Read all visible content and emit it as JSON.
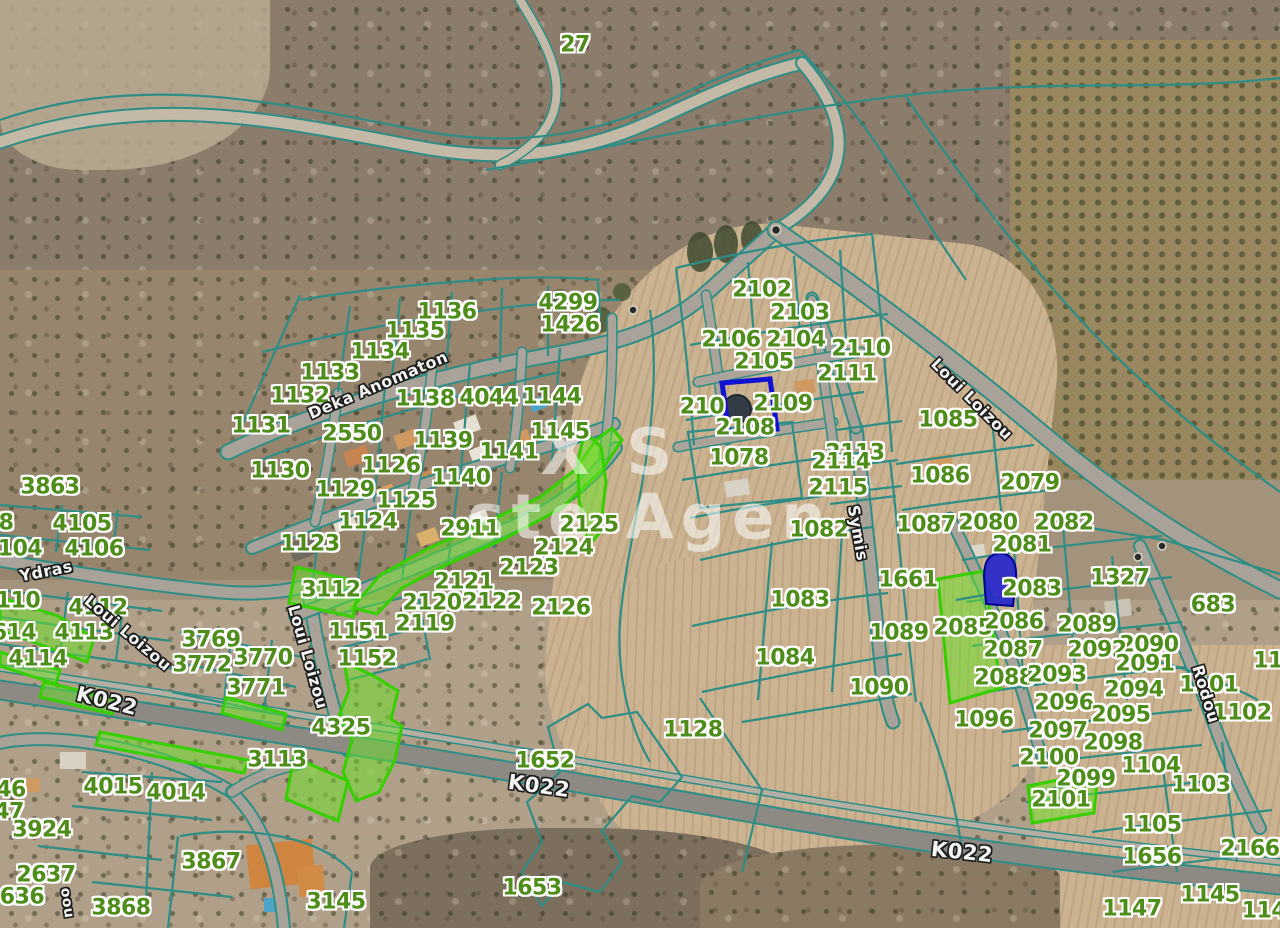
{
  "map": {
    "watermark": {
      "line1": "X S",
      "line2": "ste Agen"
    },
    "colors": {
      "parcel_number_green": "#4f8d1b",
      "boundary_teal": "#2e8e86",
      "highlight_green": "#35cf00",
      "selection_blue": "#1111d4",
      "road_label_white": "#f4f4f2"
    },
    "parcel_labels": [
      {
        "text": "27",
        "x": 575,
        "y": 45
      },
      {
        "text": "1136",
        "x": 447,
        "y": 312
      },
      {
        "text": "1135",
        "x": 415,
        "y": 331
      },
      {
        "text": "4299",
        "x": 568,
        "y": 303
      },
      {
        "text": "1426",
        "x": 570,
        "y": 325
      },
      {
        "text": "1134",
        "x": 380,
        "y": 352
      },
      {
        "text": "1133",
        "x": 330,
        "y": 373
      },
      {
        "text": "1132",
        "x": 300,
        "y": 396
      },
      {
        "text": "1131",
        "x": 261,
        "y": 426
      },
      {
        "text": "1138",
        "x": 425,
        "y": 399
      },
      {
        "text": "4044",
        "x": 489,
        "y": 398
      },
      {
        "text": "1144",
        "x": 552,
        "y": 397
      },
      {
        "text": "2550",
        "x": 352,
        "y": 434
      },
      {
        "text": "1139",
        "x": 443,
        "y": 441
      },
      {
        "text": "1145",
        "x": 560,
        "y": 432
      },
      {
        "text": "1141",
        "x": 509,
        "y": 452
      },
      {
        "text": "1130",
        "x": 280,
        "y": 471
      },
      {
        "text": "1126",
        "x": 391,
        "y": 466
      },
      {
        "text": "1140",
        "x": 461,
        "y": 478
      },
      {
        "text": "1129",
        "x": 345,
        "y": 490
      },
      {
        "text": "1125",
        "x": 406,
        "y": 501
      },
      {
        "text": "1124",
        "x": 368,
        "y": 522
      },
      {
        "text": "1123",
        "x": 310,
        "y": 544
      },
      {
        "text": "2911",
        "x": 470,
        "y": 529
      },
      {
        "text": "2125",
        "x": 589,
        "y": 525
      },
      {
        "text": "2124",
        "x": 564,
        "y": 548
      },
      {
        "text": "2123",
        "x": 529,
        "y": 568
      },
      {
        "text": "3112",
        "x": 331,
        "y": 590
      },
      {
        "text": "2121",
        "x": 464,
        "y": 582
      },
      {
        "text": "2120",
        "x": 432,
        "y": 603
      },
      {
        "text": "2122",
        "x": 492,
        "y": 602
      },
      {
        "text": "2126",
        "x": 561,
        "y": 608
      },
      {
        "text": "2119",
        "x": 425,
        "y": 624
      },
      {
        "text": "1151",
        "x": 358,
        "y": 632
      },
      {
        "text": "1152",
        "x": 367,
        "y": 659
      },
      {
        "text": "2102",
        "x": 762,
        "y": 290
      },
      {
        "text": "2103",
        "x": 800,
        "y": 313
      },
      {
        "text": "2106",
        "x": 731,
        "y": 340
      },
      {
        "text": "2104",
        "x": 796,
        "y": 340
      },
      {
        "text": "2110",
        "x": 861,
        "y": 349
      },
      {
        "text": "2105",
        "x": 764,
        "y": 362
      },
      {
        "text": "2111",
        "x": 847,
        "y": 374
      },
      {
        "text": "210",
        "x": 702,
        "y": 407
      },
      {
        "text": "2109",
        "x": 783,
        "y": 404
      },
      {
        "text": "2108",
        "x": 745,
        "y": 428
      },
      {
        "text": "1078",
        "x": 739,
        "y": 458
      },
      {
        "text": "2113",
        "x": 855,
        "y": 453
      },
      {
        "text": "1085",
        "x": 948,
        "y": 420
      },
      {
        "text": "2114",
        "x": 841,
        "y": 462
      },
      {
        "text": "1086",
        "x": 940,
        "y": 476
      },
      {
        "text": "2115",
        "x": 838,
        "y": 488
      },
      {
        "text": "2079",
        "x": 1030,
        "y": 483
      },
      {
        "text": "1082",
        "x": 819,
        "y": 530
      },
      {
        "text": "1087",
        "x": 926,
        "y": 525
      },
      {
        "text": "2080",
        "x": 988,
        "y": 523
      },
      {
        "text": "2082",
        "x": 1064,
        "y": 523
      },
      {
        "text": "2081",
        "x": 1022,
        "y": 545
      },
      {
        "text": "1661",
        "x": 908,
        "y": 580
      },
      {
        "text": "1083",
        "x": 800,
        "y": 600
      },
      {
        "text": "2083",
        "x": 1032,
        "y": 589
      },
      {
        "text": "1327",
        "x": 1120,
        "y": 578
      },
      {
        "text": "683",
        "x": 1213,
        "y": 605
      },
      {
        "text": "1089",
        "x": 899,
        "y": 633
      },
      {
        "text": "2085",
        "x": 963,
        "y": 628
      },
      {
        "text": "2086",
        "x": 1014,
        "y": 622
      },
      {
        "text": "2089",
        "x": 1087,
        "y": 625
      },
      {
        "text": "2090",
        "x": 1149,
        "y": 645
      },
      {
        "text": "1084",
        "x": 785,
        "y": 658
      },
      {
        "text": "2087",
        "x": 1013,
        "y": 650
      },
      {
        "text": "2092",
        "x": 1097,
        "y": 650
      },
      {
        "text": "2091",
        "x": 1145,
        "y": 664
      },
      {
        "text": "2088",
        "x": 1004,
        "y": 678
      },
      {
        "text": "2093",
        "x": 1057,
        "y": 675
      },
      {
        "text": "2094",
        "x": 1134,
        "y": 690
      },
      {
        "text": "1101",
        "x": 1209,
        "y": 685
      },
      {
        "text": "1090",
        "x": 879,
        "y": 688
      },
      {
        "text": "2096",
        "x": 1064,
        "y": 703
      },
      {
        "text": "2095",
        "x": 1121,
        "y": 715
      },
      {
        "text": "1102",
        "x": 1242,
        "y": 713
      },
      {
        "text": "1096",
        "x": 984,
        "y": 720
      },
      {
        "text": "2097",
        "x": 1058,
        "y": 731
      },
      {
        "text": "2098",
        "x": 1113,
        "y": 743
      },
      {
        "text": "2100",
        "x": 1049,
        "y": 758
      },
      {
        "text": "1104",
        "x": 1151,
        "y": 766
      },
      {
        "text": "2099",
        "x": 1086,
        "y": 779
      },
      {
        "text": "1103",
        "x": 1201,
        "y": 785
      },
      {
        "text": "2101",
        "x": 1061,
        "y": 800
      },
      {
        "text": "1105",
        "x": 1152,
        "y": 825
      },
      {
        "text": "1656",
        "x": 1152,
        "y": 857
      },
      {
        "text": "2166",
        "x": 1250,
        "y": 849
      },
      {
        "text": "11",
        "x": 1268,
        "y": 661
      },
      {
        "text": "1145",
        "x": 1210,
        "y": 895
      },
      {
        "text": "1147",
        "x": 1132,
        "y": 909
      },
      {
        "text": "114",
        "x": 1264,
        "y": 911
      },
      {
        "text": "1128",
        "x": 693,
        "y": 730
      },
      {
        "text": "1652",
        "x": 545,
        "y": 761
      },
      {
        "text": "1653",
        "x": 532,
        "y": 888
      },
      {
        "text": "3145",
        "x": 336,
        "y": 902
      },
      {
        "text": "3863",
        "x": 50,
        "y": 487
      },
      {
        "text": "8",
        "x": 6,
        "y": 523
      },
      {
        "text": "4105",
        "x": 82,
        "y": 524
      },
      {
        "text": "104",
        "x": 20,
        "y": 549
      },
      {
        "text": "4106",
        "x": 94,
        "y": 549
      },
      {
        "text": "110",
        "x": 18,
        "y": 601
      },
      {
        "text": "4112",
        "x": 98,
        "y": 608
      },
      {
        "text": "614",
        "x": 14,
        "y": 633
      },
      {
        "text": "4113",
        "x": 84,
        "y": 633
      },
      {
        "text": "4114",
        "x": 38,
        "y": 659
      },
      {
        "text": "3769",
        "x": 211,
        "y": 640
      },
      {
        "text": "3770",
        "x": 263,
        "y": 658
      },
      {
        "text": "3772",
        "x": 202,
        "y": 665
      },
      {
        "text": "3771",
        "x": 256,
        "y": 688
      },
      {
        "text": "4325",
        "x": 341,
        "y": 728
      },
      {
        "text": "3113",
        "x": 277,
        "y": 760
      },
      {
        "text": "4015",
        "x": 113,
        "y": 787
      },
      {
        "text": "4014",
        "x": 176,
        "y": 793
      },
      {
        "text": "46",
        "x": 11,
        "y": 790
      },
      {
        "text": "47",
        "x": 9,
        "y": 812
      },
      {
        "text": "3924",
        "x": 42,
        "y": 830
      },
      {
        "text": "2637",
        "x": 46,
        "y": 875
      },
      {
        "text": "636",
        "x": 22,
        "y": 897
      },
      {
        "text": "3867",
        "x": 211,
        "y": 862
      },
      {
        "text": "3868",
        "x": 121,
        "y": 908
      }
    ],
    "road_labels": [
      {
        "text": "Deka Anomaton",
        "x": 378,
        "y": 385,
        "rot": -23,
        "size": 16
      },
      {
        "text": "Ydras",
        "x": 46,
        "y": 571,
        "rot": -11,
        "size": 16
      },
      {
        "text": "Loui Loizou",
        "x": 128,
        "y": 633,
        "rot": 40,
        "size": 16
      },
      {
        "text": "Loui Loizou",
        "x": 308,
        "y": 657,
        "rot": 74,
        "size": 16
      },
      {
        "text": "Loui Loizou",
        "x": 972,
        "y": 399,
        "rot": 45,
        "size": 16
      },
      {
        "text": "Symis",
        "x": 858,
        "y": 533,
        "rot": 80,
        "size": 16
      },
      {
        "text": "Rodou",
        "x": 1206,
        "y": 694,
        "rot": 73,
        "size": 16
      },
      {
        "text": "oou",
        "x": 67,
        "y": 903,
        "rot": 82,
        "size": 14
      },
      {
        "text": "K022",
        "x": 107,
        "y": 701,
        "rot": 14,
        "size": 21
      },
      {
        "text": "K022",
        "x": 539,
        "y": 786,
        "rot": 8,
        "size": 21
      },
      {
        "text": "K022",
        "x": 962,
        "y": 852,
        "rot": 6,
        "size": 21
      }
    ]
  }
}
